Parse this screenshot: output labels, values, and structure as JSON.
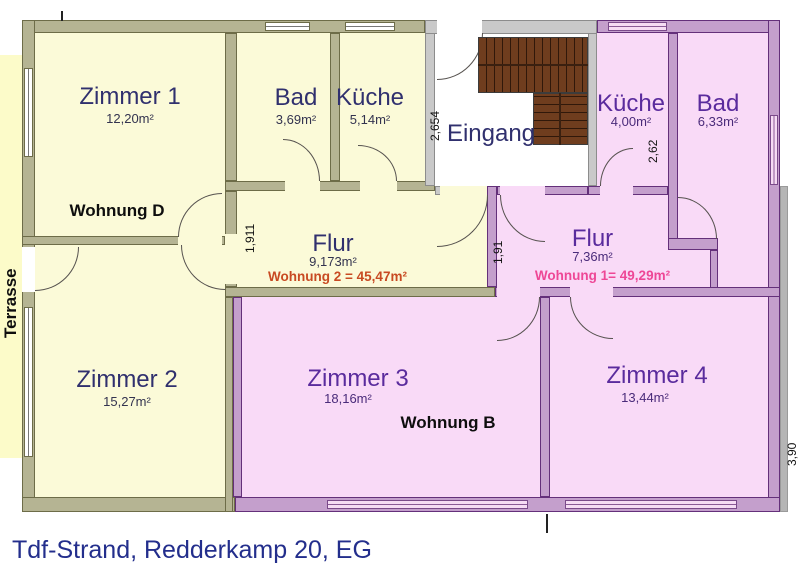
{
  "title": "Tdf-Strand, Redderkamp 20, EG",
  "outside": {
    "terrasse_label": "Terrasse"
  },
  "apartment_labels": {
    "wohnung_d": "Wohnung D",
    "wohnung_b": "Wohnung B",
    "wohnung_2_area": "Wohnung 2 = 45,47m²",
    "wohnung_1_area": "Wohnung 1= 49,29m²"
  },
  "rooms": {
    "zimmer1": {
      "name": "Zimmer 1",
      "area": "12,20m²"
    },
    "bad_d": {
      "name": "Bad",
      "area": "3,69m²"
    },
    "kueche_d": {
      "name": "Küche",
      "area": "5,14m²"
    },
    "eingang": {
      "name": "Eingang"
    },
    "kueche_1": {
      "name": "Küche",
      "area": "4,00m²"
    },
    "bad_1": {
      "name": "Bad",
      "area": "6,33m²"
    },
    "flur_2": {
      "name": "Flur",
      "area": "9,173m²"
    },
    "flur_1": {
      "name": "Flur",
      "area": "7,36m²"
    },
    "zimmer2": {
      "name": "Zimmer 2",
      "area": "15,27m²"
    },
    "zimmer3": {
      "name": "Zimmer 3",
      "area": "18,16m²"
    },
    "zimmer4": {
      "name": "Zimmer 4",
      "area": "13,44m²"
    }
  },
  "dimensions": {
    "eingang_depth": "2,654",
    "kueche_1_depth": "2,62",
    "flur_2_width": "1,911",
    "flur_1_width": "1,91",
    "right_side": "3,90"
  },
  "colors": {
    "yellow_room": "#fbfad8",
    "pink_room": "#f9daf7",
    "terrace": "#fcfbc9",
    "olive_wall": "#b5b493",
    "purple_wall": "#c49fcc",
    "gray_wall": "#c9c9c9",
    "stairs": "#6f3d1e",
    "name_text_yellow_zone": "#30306e",
    "name_text_pink_zone": "#5a2b9d",
    "wohnung2_text": "#c84a22",
    "wohnung1_text": "#ee4796",
    "title_text": "#232e8c"
  }
}
